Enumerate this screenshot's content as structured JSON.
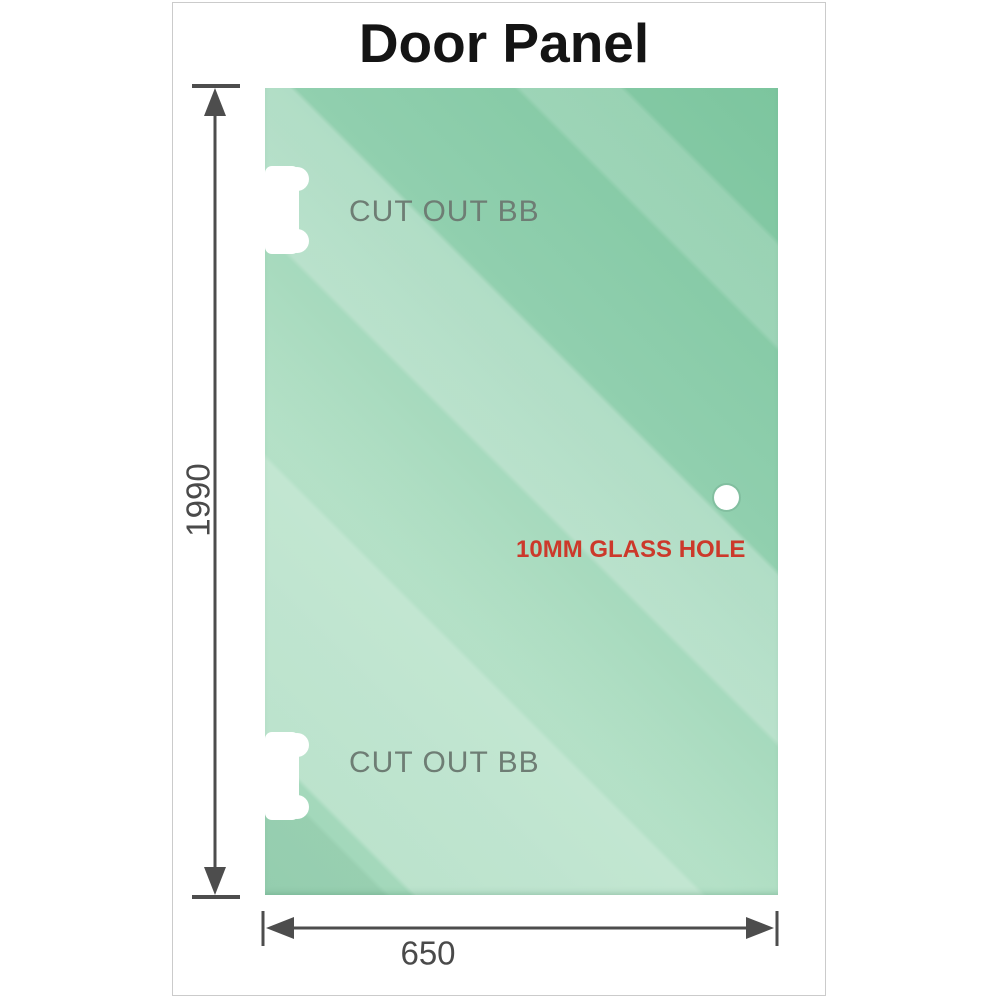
{
  "title": "Door Panel",
  "panel": {
    "cutouts": [
      {
        "label": "CUT OUT BB"
      },
      {
        "label": "CUT OUT BB"
      }
    ],
    "hole_label": "10MM GLASS HOLE"
  },
  "dimensions": {
    "height": "1990",
    "width": "650"
  },
  "colors": {
    "glass_dark": "#7cc59e",
    "glass_light": "#b9e3ca",
    "dimension_line": "#4d4d4d",
    "hole_label_red": "#cc392b",
    "cutout_label_gray": "#6e7d74",
    "frame_border": "#cbcbcb",
    "title_black": "#141414"
  }
}
